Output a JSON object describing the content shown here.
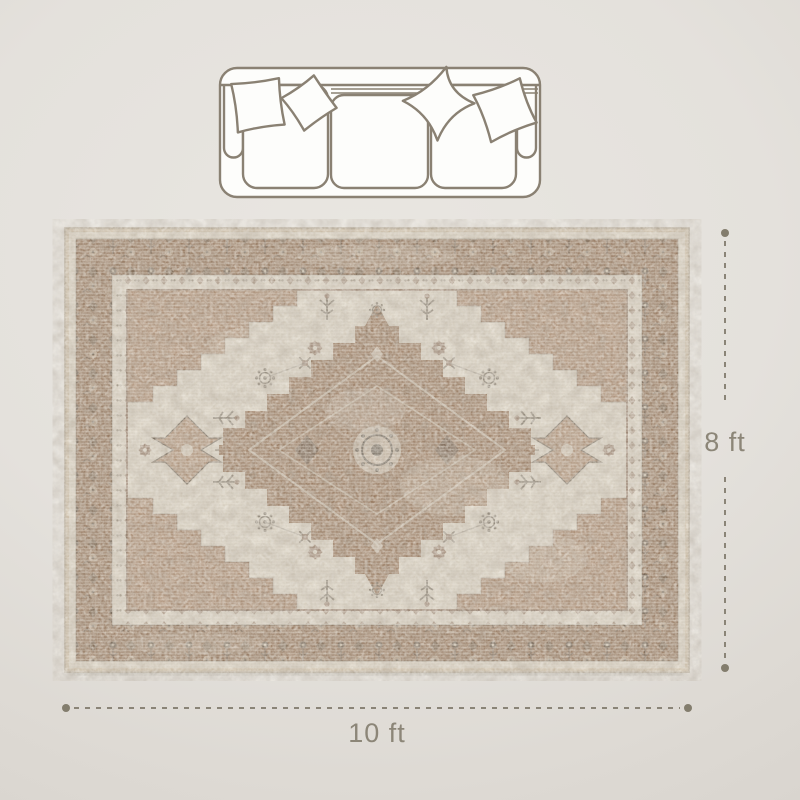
{
  "background": {
    "center_color": "#e9e6e1",
    "edge_color": "#d5d1cb"
  },
  "sofa": {
    "description": "three-seat sofa top view line drawing",
    "outline_color": "#8a8173",
    "fill_color": "#fdfdfb",
    "seat_count": 3,
    "pillow_count": 4
  },
  "rug": {
    "description": "vintage distressed medallion area rug, top view",
    "palette": {
      "base_tan": "#cdbfa9",
      "border_brown": "#96785f",
      "guard_ivory": "#d8d0c1",
      "field_ivory": "#d7cfc0",
      "spandrel_tan": "#ae8e74",
      "medallion_brown": "#9a7b61",
      "accent_dark": "#5e564c"
    }
  },
  "dimensions": {
    "line_color": "#8a8477",
    "dot_color": "#837d6d",
    "text_color": "#8c8678",
    "height": {
      "label": "8 ft"
    },
    "width": {
      "label": "10 ft"
    }
  }
}
